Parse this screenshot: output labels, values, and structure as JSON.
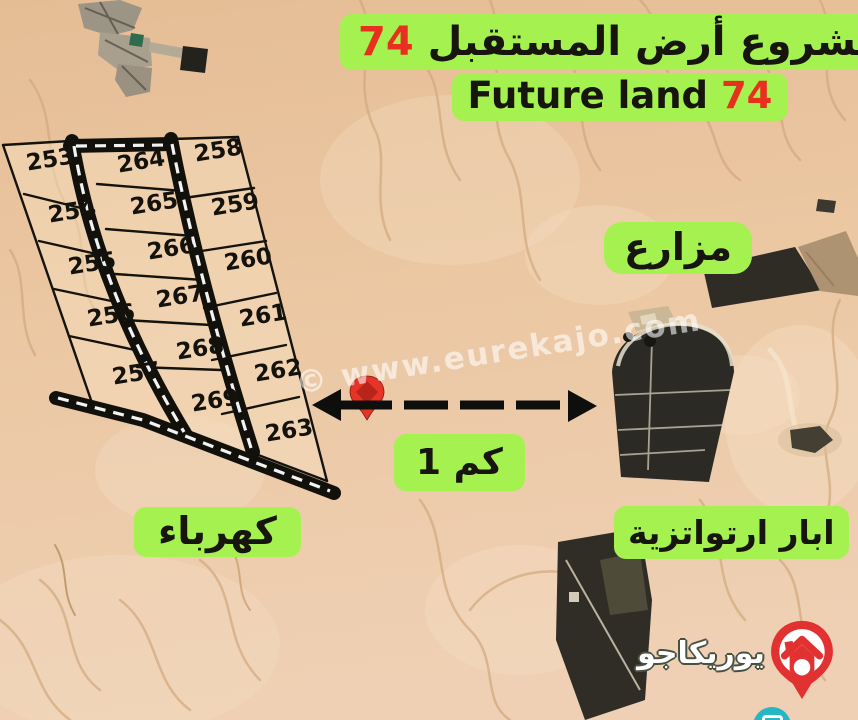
{
  "poster": {
    "title": {
      "arabic": "مشروع أرض المستقبل",
      "arabic_number": "74",
      "english": "Future land",
      "english_number": "74"
    },
    "area_labels": {
      "farms": "مزارع",
      "electricity": "كهرباء",
      "artesian_wells": "ابار ارتواتزية"
    },
    "distance_label": "1 كم",
    "watermark": "© www.eurekajo.com",
    "logo_text": "يوريكاجو",
    "plots": {
      "left_column": [
        "253",
        "254",
        "255",
        "256",
        "257"
      ],
      "middle_column": [
        "264",
        "265",
        "266",
        "267",
        "268",
        "269"
      ],
      "right_column": [
        "258",
        "259",
        "260",
        "261",
        "262",
        "263"
      ]
    },
    "colors": {
      "highlight_green": "#a4f150",
      "accent_red": "#e8301f",
      "road_black": "#12100a",
      "desert_sand": "#ebc7a2",
      "logo_red": "#e23131",
      "badge_teal": "#25b7c3"
    }
  }
}
